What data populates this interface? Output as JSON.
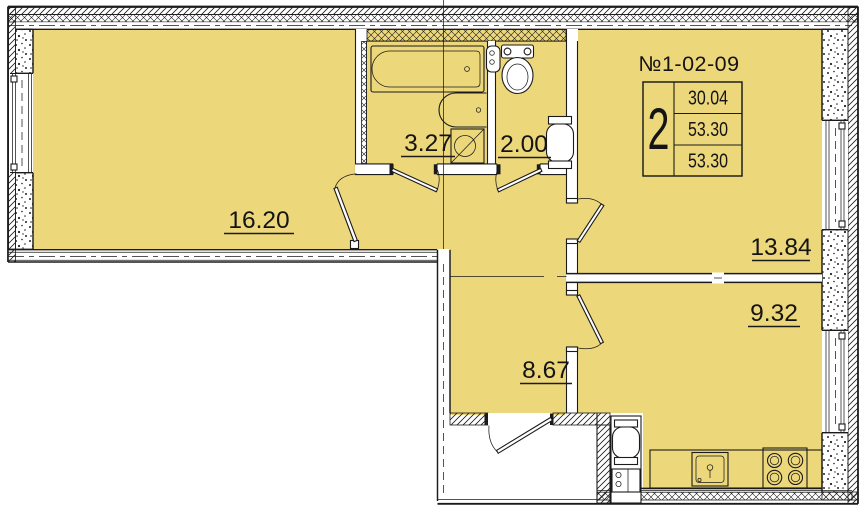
{
  "plan": {
    "unit_number": "№1-02-09",
    "info_table": {
      "rooms_count": "2",
      "row1": "30.04",
      "row2": "53.30",
      "row3": "53.30"
    },
    "room_labels": {
      "living": "16.20",
      "bathroom": "3.27",
      "wc": "2.00",
      "bedroom": "13.84",
      "kitchen_living": "9.32",
      "hallway": "8.67"
    },
    "colors": {
      "room_fill": "#edd77b",
      "line": "#1b1b1b",
      "wall_white": "#ffffff"
    },
    "icons": [
      "bathtub-icon",
      "bath-sink-icon",
      "washing-machine-icon",
      "toilet-icon",
      "corner-sink-icon",
      "water-heater-icon",
      "gas-heater-icon",
      "kitchen-sink-icon",
      "stove-icon",
      "door-swing-icon",
      "window-icon"
    ]
  }
}
